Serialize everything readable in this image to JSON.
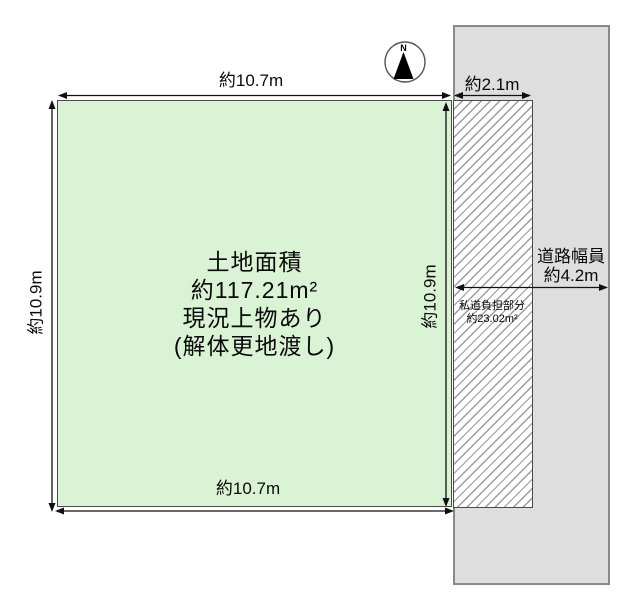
{
  "diagram": {
    "type": "real-estate land plot diagram",
    "compass": {
      "north_label": "N"
    },
    "plot": {
      "info_line1": "土地面積",
      "info_line2": "約117.21m²",
      "info_line3": "現況上物あり",
      "info_line4": "(解体更地渡し)"
    },
    "dimensions": {
      "top_width": "約10.7m",
      "bottom_width": "約10.7m",
      "left_height": "約10.9m",
      "right_height": "約10.9m",
      "setback_width": "約2.1m"
    },
    "road": {
      "label_line1": "道路幅員",
      "label_line2": "約4.2m"
    },
    "private_road": {
      "label_line1": "私道負担部分",
      "label_line2": "約23.02m²"
    },
    "colors": {
      "plot_fill": "#daf3d4",
      "road_fill": "#dedede",
      "road_border": "#8a8a8a",
      "hatch_line": "#9b9b9b",
      "dimension_line": "#111111"
    }
  }
}
